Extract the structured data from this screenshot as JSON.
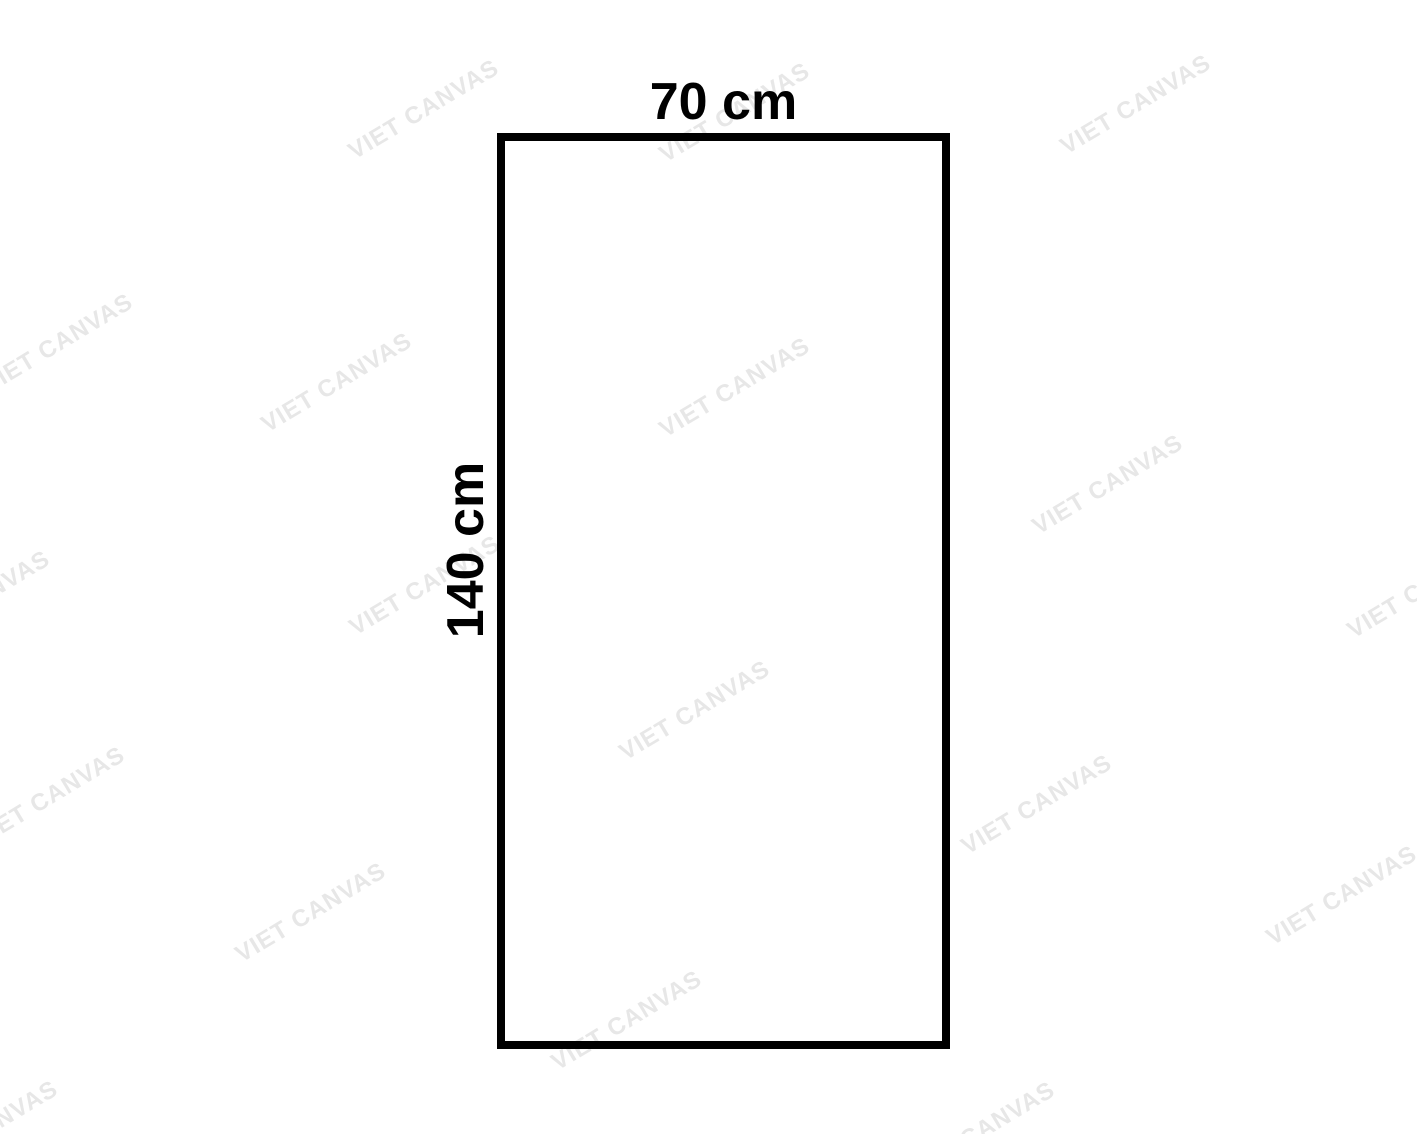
{
  "page": {
    "background_color": "#ffffff"
  },
  "diagram": {
    "width_label": "70 cm",
    "height_label": "140 cm",
    "label_color": "#000000",
    "rectangle": {
      "stroke_color": "#000000",
      "stroke_width_px": 8
    }
  },
  "watermark": {
    "text": "VIET CANVAS",
    "color": "#e7e7e7",
    "rotation_deg": -31,
    "instances": [
      {
        "x": 424,
        "y": 110
      },
      {
        "x": 735,
        "y": 113
      },
      {
        "x": 1136,
        "y": 105
      },
      {
        "x": 58,
        "y": 344
      },
      {
        "x": 337,
        "y": 383
      },
      {
        "x": 735,
        "y": 388
      },
      {
        "x": 1108,
        "y": 485
      },
      {
        "x": 1423,
        "y": 589
      },
      {
        "x": -25,
        "y": 601
      },
      {
        "x": 425,
        "y": 586
      },
      {
        "x": 695,
        "y": 711
      },
      {
        "x": 50,
        "y": 797
      },
      {
        "x": 1037,
        "y": 805
      },
      {
        "x": 311,
        "y": 913
      },
      {
        "x": 1342,
        "y": 896
      },
      {
        "x": 627,
        "y": 1021
      },
      {
        "x": 980,
        "y": 1132
      },
      {
        "x": -17,
        "y": 1131
      }
    ]
  }
}
